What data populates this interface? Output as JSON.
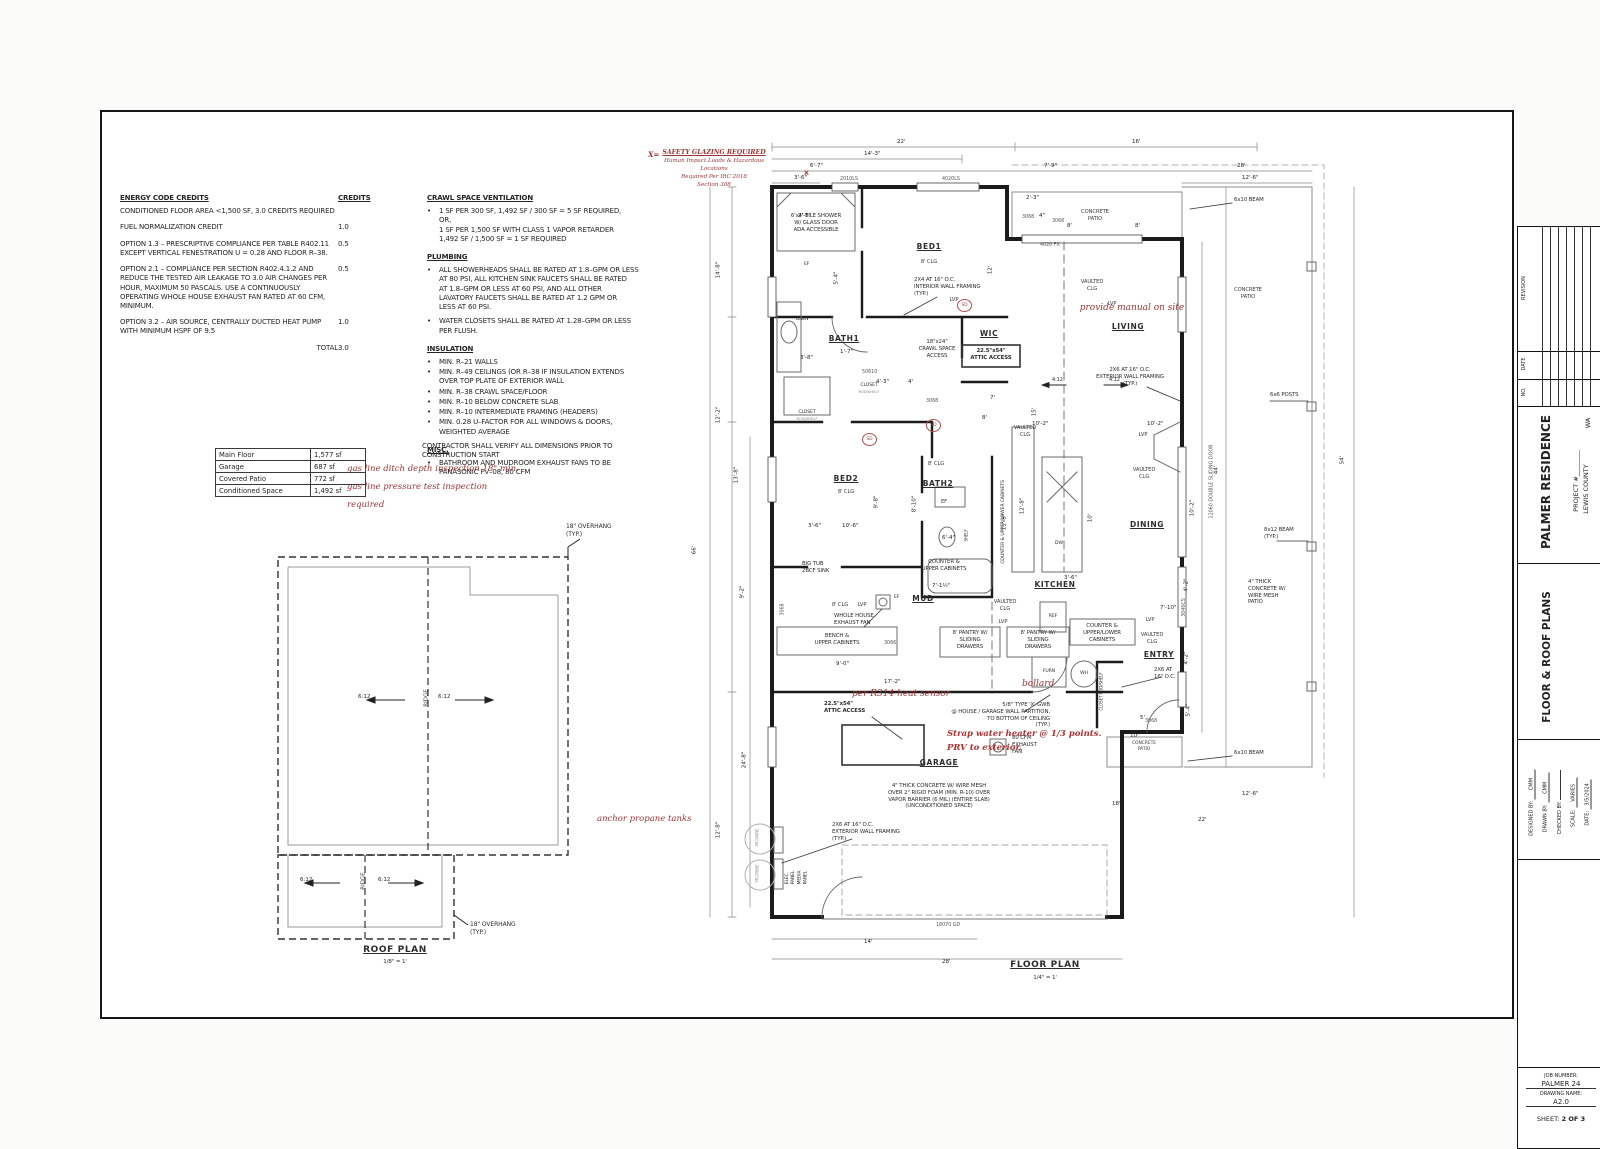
{
  "notes": {
    "energy": {
      "title": "ENERGY CODE CREDITS",
      "credits_label": "CREDITS",
      "rows": [
        {
          "text": "CONDITIONED FLOOR AREA <1,500 SF, 3.0 CREDITS REQUIRED",
          "credit": ""
        },
        {
          "text": "FUEL NORMALIZATION CREDIT",
          "credit": "1.0"
        },
        {
          "text": "OPTION 1.3 – PRESCRIPTIVE COMPLIANCE PER TABLE R402.11\nEXCEPT VERTICAL FENESTRATION U = 0.28 AND FLOOR R–38.",
          "credit": "0.5"
        },
        {
          "text": "OPTION 2.1 – COMPLIANCE PER SECTION R402.4.1.2 AND\nREDUCE THE TESTED AIR LEAKAGE TO 3.0 AIR CHANGES PER\nHOUR, MAXIMUM 50 PASCALS. USE A CONTINUOUSLY\nOPERATING WHOLE HOUSE EXHAUST FAN RATED AT 60 CFM,\nMINIMUM.",
          "credit": "0.5"
        },
        {
          "text": "OPTION 3.2 – AIR SOURCE, CENTRALLY DUCTED HEAT PUMP\nWITH MINIMUM HSPF OF 9.5",
          "credit": "1.0"
        }
      ],
      "total_label": "TOTAL",
      "total_value": "3.0"
    },
    "crawl": {
      "title": "CRAWL SPACE VENTILATION",
      "items": [
        "1 SF PER 300 SF, 1,492 SF / 300 SF = 5 SF REQUIRED,\nOR,\n1 SF PER 1,500 SF WITH CLASS 1 VAPOR RETARDER\n1,492 SF / 1,500 SF = 1 SF REQUIRED"
      ]
    },
    "plumbing": {
      "title": "PLUMBING",
      "items": [
        "ALL SHOWERHEADS SHALL BE RATED AT 1.8–GPM OR LESS\nAT 80 PSI, ALL KITCHEN SINK FAUCETS SHALL BE RATED\nAT 1.8–GPM OR LESS AT 60 PSI, AND ALL OTHER\nLAVATORY FAUCETS SHALL BE RATED AT 1.2 GPM OR\nLESS AT 60 PSI.",
        "WATER CLOSETS SHALL BE RATED AT 1.28–GPM OR LESS\nPER FLUSH."
      ]
    },
    "insulation": {
      "title": "INSULATION",
      "items": [
        "MIN. R–21 WALLS",
        "MIN. R–49 CEILINGS (OR R–38 IF INSULATION EXTENDS\nOVER TOP PLATE OF EXTERIOR WALL",
        "MIN. R–38 CRAWL SPACE/FLOOR",
        "MIN. R–10 BELOW CONCRETE SLAB",
        "MIN. R–10 INTERMEDIATE FRAMING (HEADERS)",
        "MIN. 0.28 U–FACTOR FOR ALL WINDOWS & DOORS,\nWEIGHTED AVERAGE"
      ]
    },
    "misc": {
      "title": "MISC.",
      "items": [
        "BATHROOM AND MUDROOM EXHAUST FANS TO BE\nPANASONIC FV–08, 80 CFM"
      ]
    },
    "contractor": "CONTRACTOR SHALL VERIFY ALL DIMENSIONS PRIOR TO\nCONSTRUCTION START"
  },
  "area": {
    "rows": [
      {
        "label": "Main Floor",
        "value": "1,577 sf"
      },
      {
        "label": "Garage",
        "value": "687 sf"
      },
      {
        "label": "Covered Patio",
        "value": "772 sf"
      },
      {
        "label": "Conditioned Space",
        "value": "1,492 sf"
      }
    ]
  },
  "rednotes": {
    "gas1": "gas line ditch depth inspection 18\" min.",
    "gas2": "gas line pressure test inspection",
    "gas3": "required",
    "anchor": "anchor propane tanks",
    "r314": "per R314 heat sensor",
    "bollard": "bollard",
    "manual": "provide manual on site",
    "strap1": "Strap water heater @ 1/3 points.",
    "strap2": "PRV to exterior.",
    "xeq": "X=",
    "g1": "SAFETY GLAZING REQUIRED",
    "g2": "Human Impact Loads & Hazardous",
    "g3": "Locations",
    "g4": "Required Per IRC 2018",
    "g5": "Section 308"
  },
  "roof": {
    "title": "ROOF PLAN",
    "scale": "1/8\" = 1'",
    "slope": "6:12",
    "ridge": "RIDGE",
    "overhang": "18\" OVERHANG\n(TYP.)"
  },
  "fp": {
    "title": "FLOOR PLAN",
    "scale": "1/4\" = 1'",
    "sd": "SD",
    "xmark": "X",
    "rooms": {
      "bed1": "BED1",
      "bath1": "BATH1",
      "wic": "WIC",
      "living": "LIVING",
      "bed2": "BED2",
      "bath2": "BATH2",
      "dining": "DINING",
      "kitchen": "KITCHEN",
      "mud": "MUD",
      "entry": "ENTRY",
      "garage": "GARAGE",
      "clg8": "8' CLG",
      "vclg": "VAULTED\nCLG",
      "lvp": "LVP",
      "patio": "CONCRETE\nPATIO"
    },
    "ann": {
      "shower": "6'x4' TILE SHOWER\nW/ GLASS DOOR\nADA ACCESSIBLE",
      "intframe": "2X4 AT 16\" O.C.\nINTERIOR WALL FRAMING\n(TYP.)",
      "extframe": "2X6 AT 16\" O.C.\nEXTERIOR WALL FRAMING\n(TYP.)",
      "entryframe": "2X6 AT\n16\" O.C.",
      "crawlacc": "18\"x24\"\nCRAWL SPACE\nACCESS",
      "atticacc": "22.5\"x54\"\nATTIC ACCESS",
      "beam610": "6x10 BEAM",
      "posts": "6x6 POSTS",
      "beam812": "8x12 BEAM\n(TYP.)",
      "patioconc": "4\" THICK\nCONCRETE W/\nWIRE MESH\nPATIO",
      "whef": "WHOLE HOUSE\nEXHAUST FAN",
      "bench": "BENCH &\nUPPER CABINETS",
      "pantry": "8' PANTRY W/\nSLIDING\nDRAWERS",
      "counterup": "COUNTER &\nUPPER CABINETS",
      "counterul": "COUNTER &\nUPPER/LOWER\nCABINETS",
      "counterulrot": "COUNTER & UPPER/LOWER CABINETS",
      "bigtub": "BIG TUB\n2BCF SINK",
      "fan80": "80 CFM\nEXHAUST\nFAN",
      "gwb": "5/8\" TYPE 'X' GWB\n@ HOUSE / GARAGE WALL PARTITION,\nTO BOTTOM OF CEILING\n(TYP.)",
      "slab": "4\" THICK CONCRETE W/ WIRE MESH\nOVER 2\" RIGID FOAM (MIN. R-10) OVER\nVAPOR BARRIER (6 MIL) (ENTIRE SLAB)\n(UNCONDITIONED SPACE)",
      "elec": "ELEC.\nPANEL",
      "media": "MEDIA\nPANEL",
      "propane": "PROPANE",
      "furn": "FURN",
      "wh": "WH",
      "ref": "REF",
      "dw": "DW",
      "ef": "EF",
      "linen": "LINEN",
      "closet": "CLOSET",
      "rodshelf": "ROD/SHELF",
      "closetrot": "CLOSET ROD/SHELF",
      "shelf": "SHELF",
      "slope412a": "4:12",
      "slope412b": "4:12"
    },
    "dim_labels": [
      {
        "t": "22'",
        "x": 205,
        "y": 12
      },
      {
        "t": "16'",
        "x": 440,
        "y": 12
      },
      {
        "t": "14'-3\"",
        "x": 172,
        "y": 24
      },
      {
        "t": "6'-7\"",
        "x": 118,
        "y": 36
      },
      {
        "t": "7'-9\"",
        "x": 352,
        "y": 36
      },
      {
        "t": "28'",
        "x": 545,
        "y": 36
      },
      {
        "t": "3'-6\"",
        "x": 102,
        "y": 48
      },
      {
        "t": "12'-6\"",
        "x": 550,
        "y": 48
      },
      {
        "t": "2'-3\"",
        "x": 334,
        "y": 68
      },
      {
        "t": "4\"",
        "x": 347,
        "y": 86
      },
      {
        "t": "8'",
        "x": 375,
        "y": 96
      },
      {
        "t": "8'",
        "x": 443,
        "y": 96
      },
      {
        "t": "14'-8\"",
        "x": 32,
        "y": 140,
        "r": 1
      },
      {
        "t": "12'-2\"",
        "x": 32,
        "y": 285,
        "r": 1
      },
      {
        "t": "13'-8\"",
        "x": 50,
        "y": 345,
        "r": 1
      },
      {
        "t": "66'",
        "x": 12,
        "y": 420,
        "r": 1
      },
      {
        "t": "9'-2\"",
        "x": 58,
        "y": 462,
        "r": 1
      },
      {
        "t": "24'-8\"",
        "x": 58,
        "y": 630,
        "r": 1
      },
      {
        "t": "12'-8\"",
        "x": 32,
        "y": 700,
        "r": 1
      },
      {
        "t": "3'-8\"",
        "x": 108,
        "y": 228
      },
      {
        "t": "2'-8\"",
        "x": 106,
        "y": 86
      },
      {
        "t": "5'-4\"",
        "x": 152,
        "y": 148,
        "r": 1
      },
      {
        "t": "1'-7\"",
        "x": 148,
        "y": 222
      },
      {
        "t": "3'-6\"",
        "x": 116,
        "y": 396
      },
      {
        "t": "12'",
        "x": 308,
        "y": 140,
        "r": 1
      },
      {
        "t": "15'",
        "x": 352,
        "y": 282,
        "r": 1
      },
      {
        "t": "4'-3\"",
        "x": 184,
        "y": 252
      },
      {
        "t": "4'",
        "x": 216,
        "y": 252
      },
      {
        "t": "7'",
        "x": 298,
        "y": 268
      },
      {
        "t": "8'",
        "x": 290,
        "y": 288
      },
      {
        "t": "10'-6\"",
        "x": 150,
        "y": 396
      },
      {
        "t": "9'-8\"",
        "x": 192,
        "y": 372,
        "r": 1
      },
      {
        "t": "8'-10\"",
        "x": 228,
        "y": 374,
        "r": 1
      },
      {
        "t": "6'-4\"",
        "x": 250,
        "y": 408
      },
      {
        "t": "10'-2\"",
        "x": 340,
        "y": 294
      },
      {
        "t": "10'-2\"",
        "x": 455,
        "y": 294
      },
      {
        "t": "12'-8\"",
        "x": 336,
        "y": 376,
        "r": 1
      },
      {
        "t": "11'-8\"",
        "x": 318,
        "y": 392,
        "r": 1
      },
      {
        "t": "10'",
        "x": 408,
        "y": 388,
        "r": 1
      },
      {
        "t": "3'-6\"",
        "x": 372,
        "y": 448
      },
      {
        "t": "17'-2\"",
        "x": 192,
        "y": 552
      },
      {
        "t": "9'-0\"",
        "x": 144,
        "y": 534
      },
      {
        "t": "7'-1½\"",
        "x": 240,
        "y": 456
      },
      {
        "t": "7'-10\"",
        "x": 468,
        "y": 478
      },
      {
        "t": "44'",
        "x": 534,
        "y": 340,
        "r": 1
      },
      {
        "t": "54'",
        "x": 660,
        "y": 330,
        "r": 1
      },
      {
        "t": "10'-2\"",
        "x": 506,
        "y": 378,
        "r": 1
      },
      {
        "t": "4'-2\"",
        "x": 502,
        "y": 455,
        "r": 1
      },
      {
        "t": "4'-2\"",
        "x": 502,
        "y": 528,
        "r": 1
      },
      {
        "t": "5'-4\"",
        "x": 504,
        "y": 580,
        "r": 1
      },
      {
        "t": "5'",
        "x": 448,
        "y": 588
      },
      {
        "t": "10'",
        "x": 438,
        "y": 606
      },
      {
        "t": "18'",
        "x": 420,
        "y": 674
      },
      {
        "t": "12'-6\"",
        "x": 550,
        "y": 664
      },
      {
        "t": "22'",
        "x": 506,
        "y": 690
      },
      {
        "t": "14'",
        "x": 172,
        "y": 812
      },
      {
        "t": "28'",
        "x": 250,
        "y": 832
      }
    ],
    "tag_labels": [
      {
        "t": "2010LS",
        "x": 148,
        "y": 50
      },
      {
        "t": "4020LS",
        "x": 250,
        "y": 50
      },
      {
        "t": "3068",
        "x": 330,
        "y": 88
      },
      {
        "t": "3068",
        "x": 360,
        "y": 92
      },
      {
        "t": "4020 FX",
        "x": 348,
        "y": 116
      },
      {
        "t": "50610",
        "x": 170,
        "y": 243
      },
      {
        "t": "3068",
        "x": 234,
        "y": 272
      },
      {
        "t": "3068",
        "x": 99,
        "y": 480,
        "r": 1
      },
      {
        "t": "3066",
        "x": 192,
        "y": 514
      },
      {
        "t": "12060 DOUBLE SLIDING DOOR",
        "x": 497,
        "y": 352,
        "r": 1
      },
      {
        "t": "3040CS",
        "x": 497,
        "y": 478,
        "r": 1
      },
      {
        "t": "3068",
        "x": 453,
        "y": 592
      },
      {
        "t": "18070 GD",
        "x": 244,
        "y": 796
      }
    ],
    "sd_marks": [
      {
        "x": 265,
        "y": 172
      },
      {
        "x": 234,
        "y": 292
      },
      {
        "x": 170,
        "y": 306
      }
    ],
    "x_marks": [
      {
        "x": 112,
        "y": 42
      }
    ]
  },
  "tb": {
    "revision": "REVISION",
    "date_col": "DATE",
    "no_col": "NO.",
    "project_name": "PALMER RESIDENCE",
    "project_num": "PROJECT #________",
    "county": "LEWIS COUNTY",
    "state": "WA",
    "sheet_title": "FLOOR & ROOF PLANS",
    "designed_label": "DESIGNED BY:",
    "designed_val": "CMM",
    "drawn_label": "DRAWN BY:",
    "drawn_val": "CMM",
    "checked_label": "CHECKED BY:",
    "checked_val": "",
    "scale_label": "SCALE:",
    "scale_val": "VARIES",
    "date_label": "DATE:",
    "date_val": "3/5/2024",
    "job_label": "JOB NUMBER:",
    "job_val": "PALMER 24",
    "dwg_label": "DRAWING NAME:",
    "dwg_val": "A2.0",
    "sheet_label": "SHEET:",
    "sheet_val": "2 OF 3"
  }
}
